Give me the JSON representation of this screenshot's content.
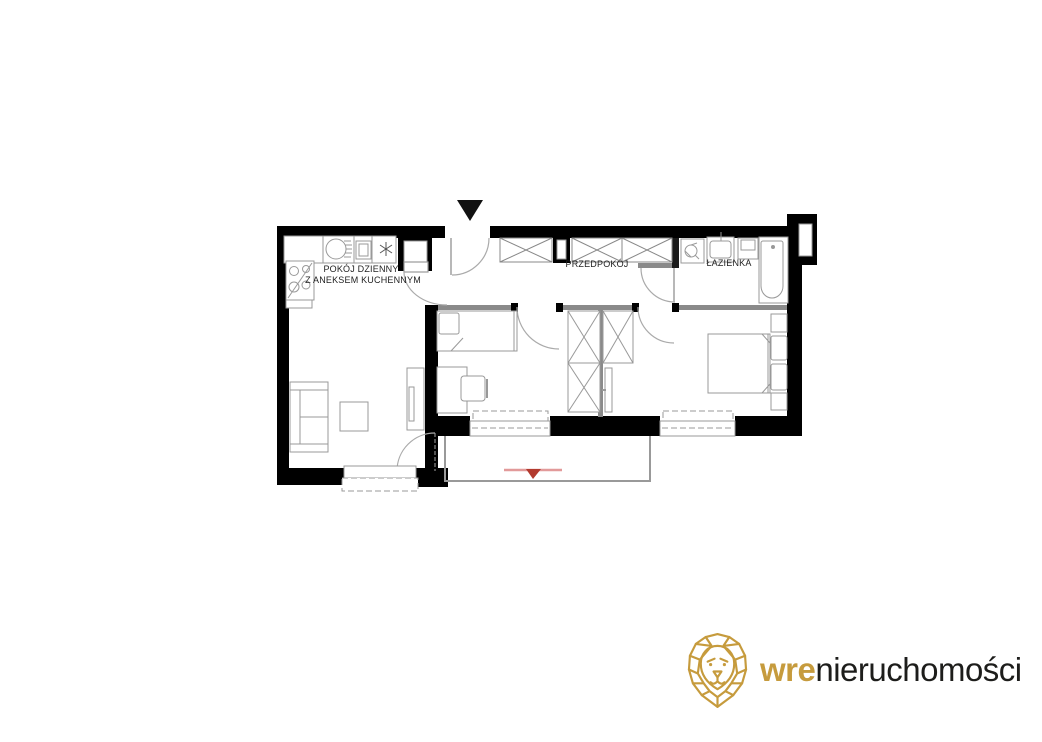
{
  "floor_plan": {
    "rooms": {
      "living_room": {
        "label_line1": "POKÓJ DZIENNY",
        "label_line2": "Z ANEKSEM KUCHENNYM"
      },
      "hallway": {
        "label": "PRZEDPOKÓJ"
      },
      "bathroom": {
        "label": "ŁAZIENKA"
      }
    },
    "markers": {
      "entrance_marker": "black triangle above entrance door",
      "balcony_marker": "red triangle on balcony railing"
    },
    "colors": {
      "outer_wall": "#000000",
      "interior_wall": "#8a8a8a",
      "furniture_line": "#999999",
      "marker_red": "#b23a2e",
      "marker_red_light": "#e29a9a",
      "background": "#ffffff"
    }
  },
  "logo": {
    "brand_gold": "wre",
    "brand_rest": "nieruchomości",
    "gold_color": "#C69B3D",
    "text_color": "#1d1d1b"
  }
}
